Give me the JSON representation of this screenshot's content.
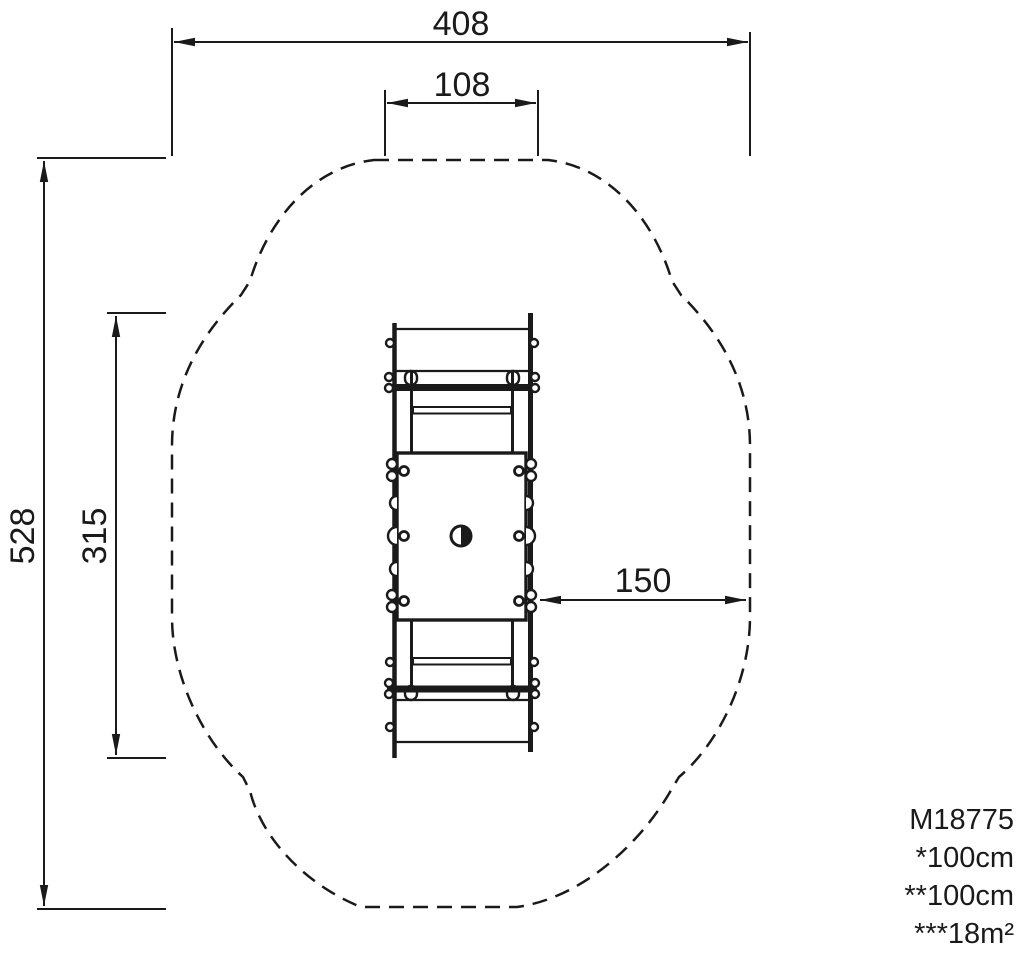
{
  "page": {
    "background_color": "#ffffff",
    "line_color": "#1a1a1a"
  },
  "dimensions": {
    "overall_width": "408",
    "inner_top_width": "108",
    "overall_depth": "528",
    "equipment_length": "315",
    "side_clearance": "150"
  },
  "legend": {
    "model_number": "M18775",
    "line_1": "*100cm",
    "line_2": "**100cm",
    "line_3": "***18m²"
  }
}
